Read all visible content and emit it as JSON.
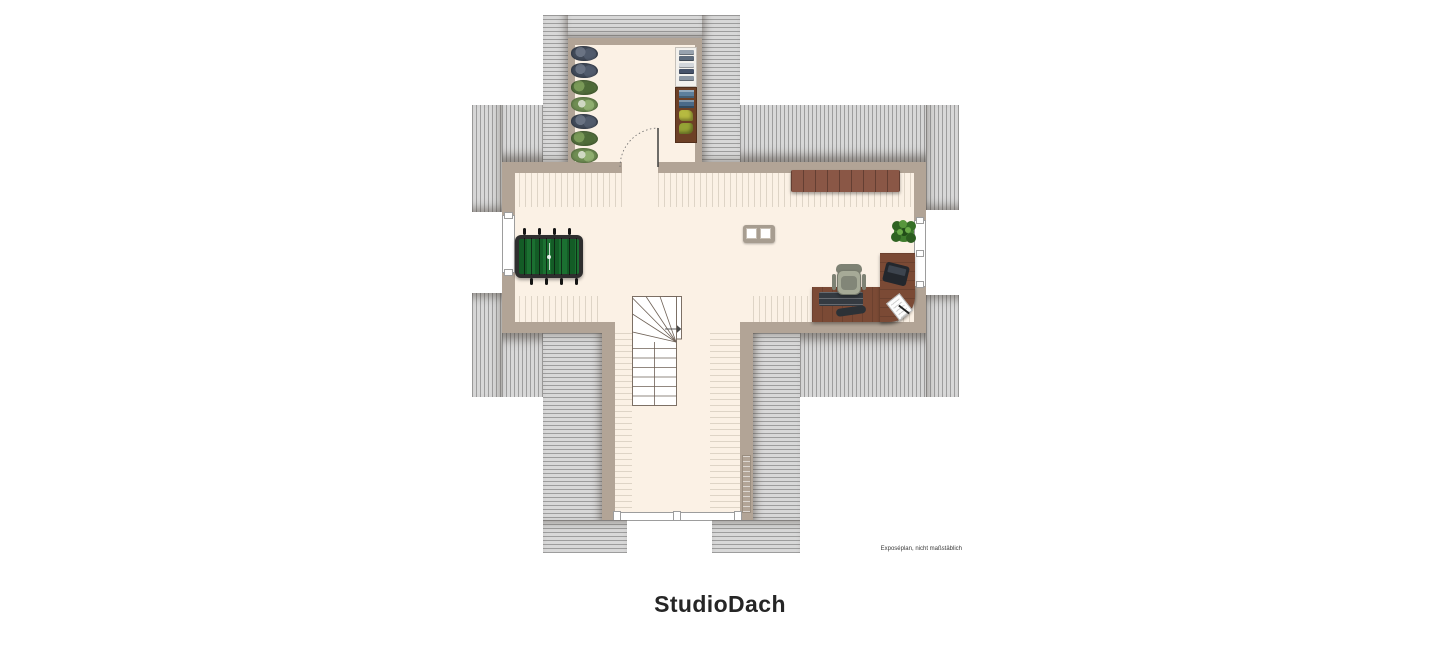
{
  "page": {
    "title": "StudioDach",
    "disclaimer": "Exposéplan, nicht maßstäblich"
  },
  "palette": {
    "background": "#ffffff",
    "roof_fill": "#d8d8d8",
    "roof_stripe": "#9d9d9d",
    "wall": "#b2a496",
    "floor": "#fbf1e5",
    "floor_hatch_line": "#ded4c6",
    "stair_line": "#6e6156",
    "sideboard_wood": "#8a5746",
    "desk_wood": "#7b4a35",
    "wardrobe_wood": "#6d4026",
    "foosball_frame": "#2e2e2e",
    "foosball_field": "#176328",
    "plant_green": "#3c7a2c"
  },
  "floorplan": {
    "label": "StudioDach",
    "rooms": [
      {
        "id": "top-dormer-room",
        "description": "dormer room with plant row, shelf and wardrobe"
      },
      {
        "id": "main-studio-room",
        "description": "large cross-shaped studio room under the roof"
      },
      {
        "id": "bottom-wing-room",
        "description": "lower wing with winder staircase and window front"
      }
    ],
    "elements": [
      {
        "id": "plants-row",
        "label": "row of potted plants"
      },
      {
        "id": "open-shelf",
        "label": "open shelf with folded clothes"
      },
      {
        "id": "wardrobe",
        "label": "wardrobe with clothes and bags"
      },
      {
        "id": "interior-door",
        "label": "door with dotted swing arc"
      },
      {
        "id": "foosball-table",
        "label": "foosball table"
      },
      {
        "id": "sideboard",
        "label": "low sideboard"
      },
      {
        "id": "side-table",
        "label": "small table with two white trays"
      },
      {
        "id": "potted-plant",
        "label": "green potted plant"
      },
      {
        "id": "corner-desk",
        "label": "L-shaped corner desk"
      },
      {
        "id": "office-chair",
        "label": "office chair"
      },
      {
        "id": "laptop",
        "label": "laptop"
      },
      {
        "id": "papers",
        "label": "papers with pen"
      },
      {
        "id": "winder-stairs",
        "label": "winder staircase with up arrow"
      },
      {
        "id": "radiator",
        "label": "radiator on wing wall"
      },
      {
        "id": "left-window",
        "label": "window in left gable wall"
      },
      {
        "id": "right-window",
        "label": "window in right gable wall"
      },
      {
        "id": "bottom-window",
        "label": "window band at wing front"
      },
      {
        "id": "roof-hatching",
        "label": "hatched roof surfaces"
      }
    ]
  }
}
